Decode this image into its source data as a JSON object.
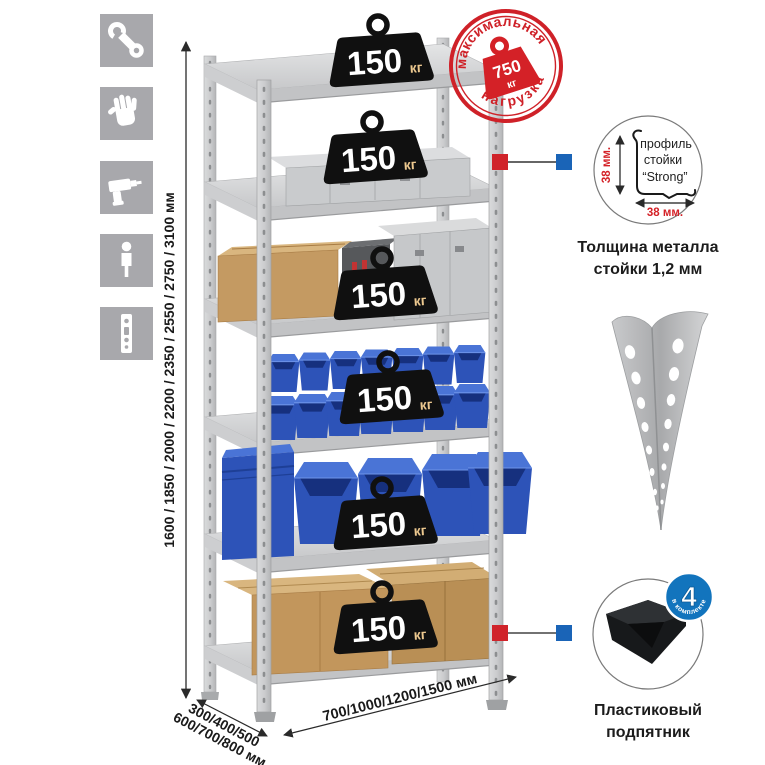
{
  "left_icons": {
    "items": [
      "wrench",
      "gloves",
      "drill",
      "person",
      "rack-post"
    ]
  },
  "dimensions": {
    "height": "1600 / 1850 / 2000 / 2200 / 2350 / 2550 / 2750 / 3100 мм",
    "depth_line1": "300/400/500",
    "depth_line2": "600/700/800 мм",
    "width": "700/1000/1200/1500 мм"
  },
  "shelf_badge": {
    "value": "150",
    "unit": "кг"
  },
  "max_load_stamp": {
    "arc_top": "максимальная",
    "arc_bottom": "нагрузка",
    "value": "750",
    "unit": "кг"
  },
  "profile_callout": {
    "label_line1": "профиль",
    "label_line2": "стойки",
    "label_line3": "“Strong”",
    "dim_vertical": "38 мм.",
    "dim_horizontal": "38 мм.",
    "caption_line1": "Толщина металла",
    "caption_line2": "стойки 1,2 мм"
  },
  "foot_callout": {
    "badge_value": "4",
    "badge_arc": "в комплекте",
    "caption_line1": "Пластиковый",
    "caption_line2": "подпятник"
  },
  "colors": {
    "accent_red": "#d0232a",
    "accent_blue": "#1a64b7",
    "bin_blue": "#2d53b8",
    "icon_gray": "#a8a8ac",
    "badge_black": "#101010"
  }
}
